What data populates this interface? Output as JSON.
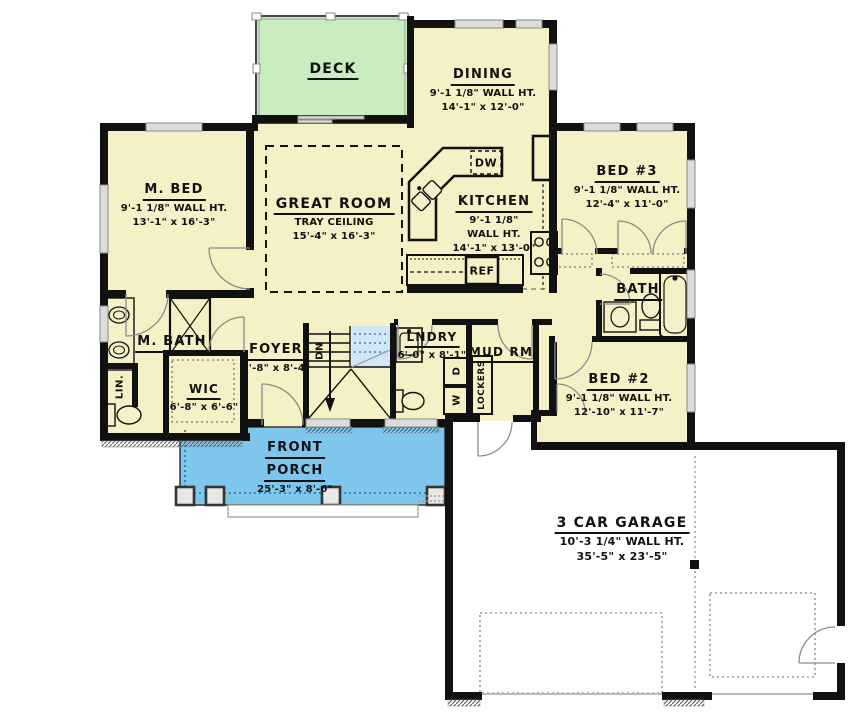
{
  "colors": {
    "c-room": "#f6f0c6",
    "c-deck": "#c9edbf",
    "c-porch": "#7fc6ed",
    "c-stair": "#cfe7f7",
    "c-wall": "#111111",
    "c-garage": "#ffffff"
  },
  "rooms": {
    "deck": {
      "name": "DECK"
    },
    "dining": {
      "name": "DINING",
      "wall_ht": "9'-1 1/8\" WALL HT.",
      "size": "14'-1\" x 12'-0\""
    },
    "master_bed": {
      "name": "M. BED",
      "wall_ht": "9'-1 1/8\" WALL HT.",
      "size": "13'-1\" x 16'-3\""
    },
    "great_room": {
      "name": "GREAT ROOM",
      "ceiling": "TRAY CEILING",
      "size": "15'-4\" x 16'-3\""
    },
    "kitchen": {
      "name": "KITCHEN",
      "wall_ht_1": "9'-1 1/8\"",
      "wall_ht_2": "WALL HT.",
      "size": "14'-1\" x 13'-0\""
    },
    "bed3": {
      "name": "BED #3",
      "wall_ht": "9'-1 1/8\" WALL HT.",
      "size": "12'-4\" x 11'-0\""
    },
    "bath": {
      "name": "BATH"
    },
    "master_bath": {
      "name": "M. BATH"
    },
    "wic": {
      "name": "WIC",
      "size": "6'-8\" x 6'-6\""
    },
    "foyer": {
      "name": "FOYER",
      "size": "5'-8\" x 8'-4\""
    },
    "laundry": {
      "name": "LNDRY",
      "size": "6'-0\" x 8'-1\""
    },
    "mud_room": {
      "name": "MUD RM"
    },
    "bed2": {
      "name": "BED #2",
      "wall_ht": "9'-1 1/8\" WALL HT.",
      "size": "12'-10\" x 11'-7\""
    },
    "front_porch": {
      "name_line1": "FRONT",
      "name_line2": "PORCH",
      "size": "25'-3\" x 8'-6\""
    },
    "garage": {
      "name": "3 CAR GARAGE",
      "wall_ht": "10'-3 1/4\" WALL HT.",
      "size": "35'-5\" x 23'-5\""
    }
  },
  "appliances": {
    "dishwasher": "DW",
    "refrigerator": "REF",
    "linen": "LIN.",
    "stairs_down": "DN",
    "dryer": "D",
    "washer": "W",
    "lockers": "LOCKERS"
  }
}
